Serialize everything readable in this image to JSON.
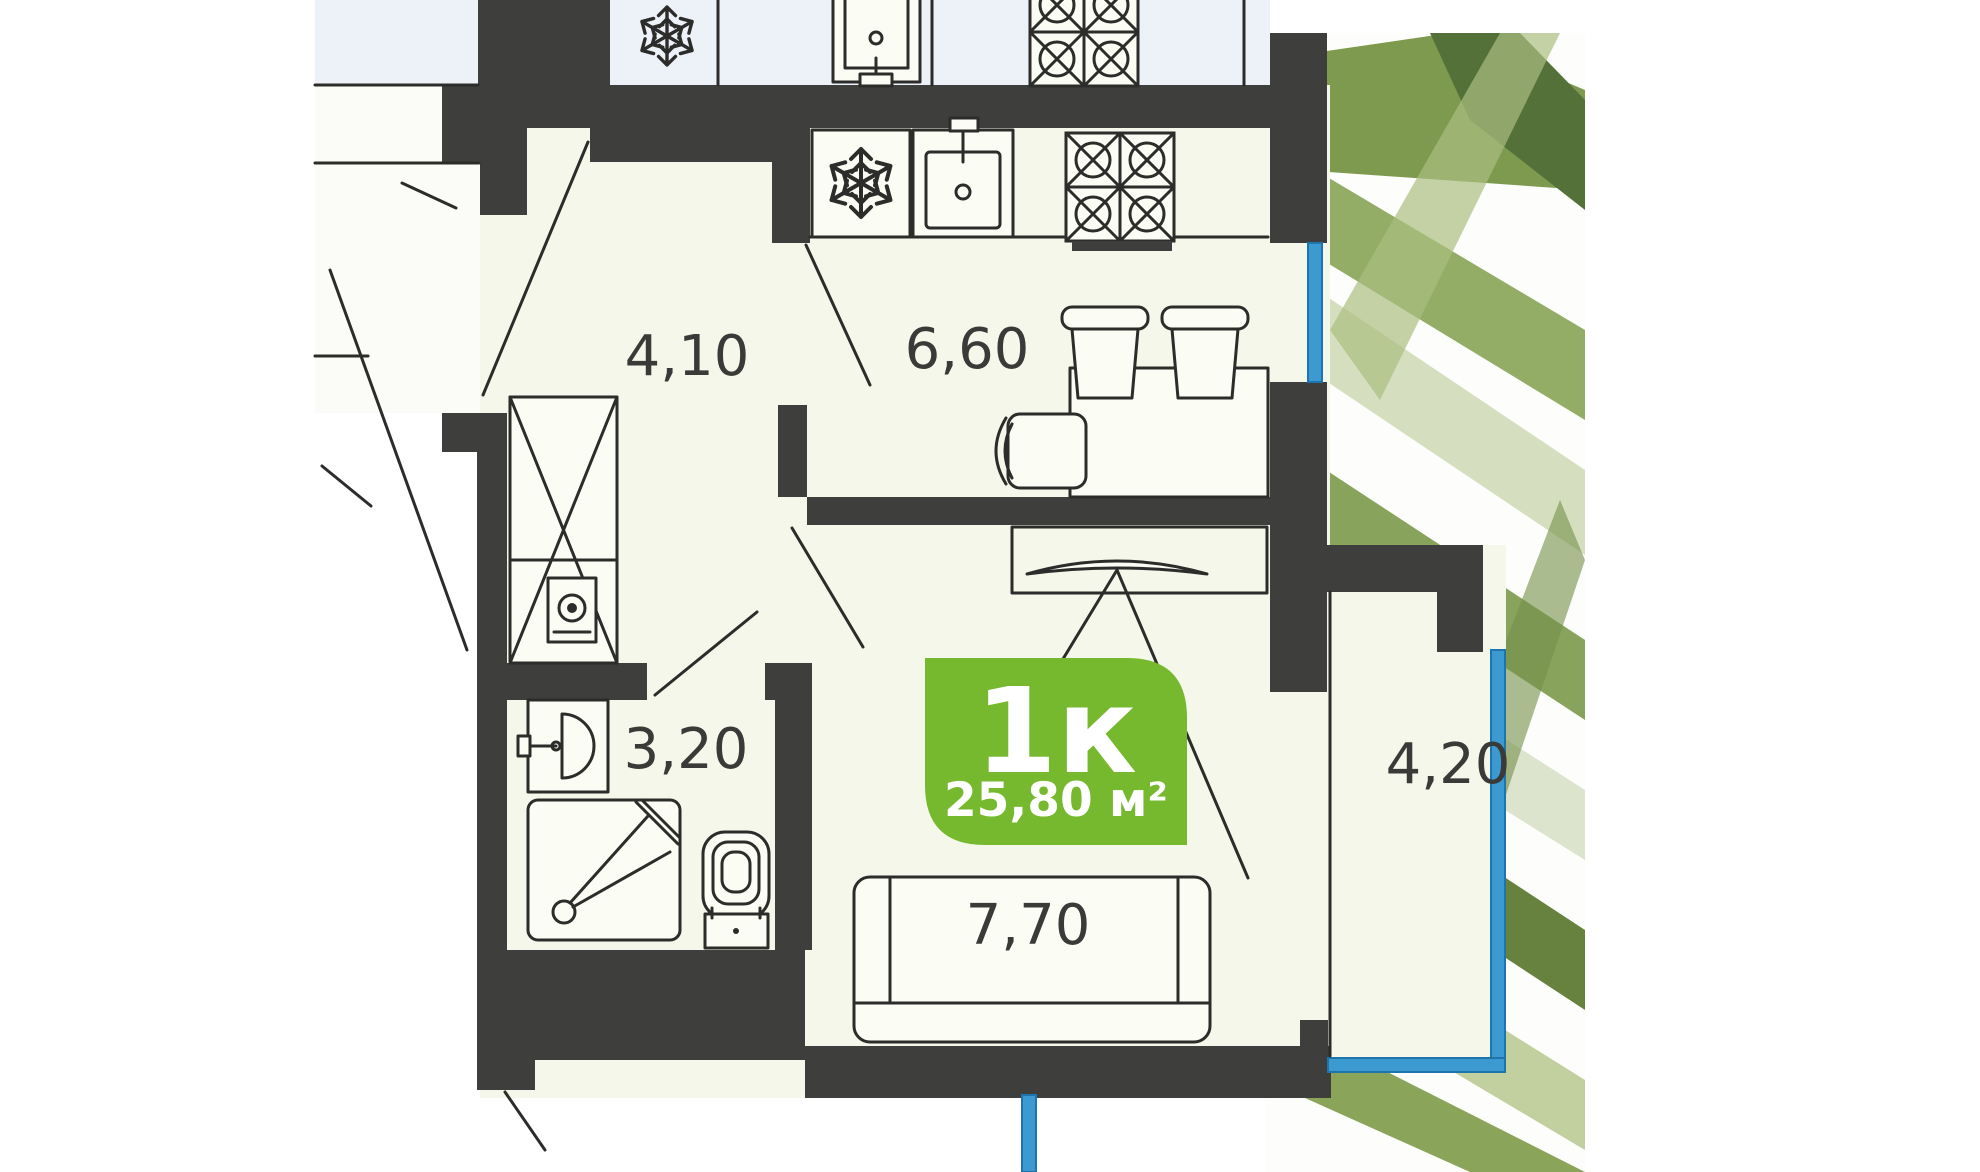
{
  "floorplan": {
    "badge": {
      "type": "1к",
      "area": "25,80 м²",
      "color": "#76b82e"
    },
    "rooms": [
      {
        "name": "hallway",
        "area": "4,10"
      },
      {
        "name": "kitchen",
        "area": "6,60"
      },
      {
        "name": "bathroom",
        "area": "3,20"
      },
      {
        "name": "living-room",
        "area": "7,70"
      },
      {
        "name": "balcony",
        "area": "4,20"
      }
    ],
    "fixtures": [
      "fridge-snowflake",
      "kitchen-sink",
      "stove-4-burners",
      "dining-table",
      "stool",
      "stool",
      "chair",
      "tv-on-shelf",
      "bed",
      "wardrobe",
      "washing-machine",
      "washbasin",
      "shower-cabin",
      "toilet"
    ],
    "colors": {
      "wall": "#3e3e3c",
      "floor": "#f5f7ea",
      "upper_floor": "#edf1f8",
      "window_glazing": "#3d9ad1",
      "badge_green": "#76b82e",
      "line": "#2c2c2a"
    }
  }
}
